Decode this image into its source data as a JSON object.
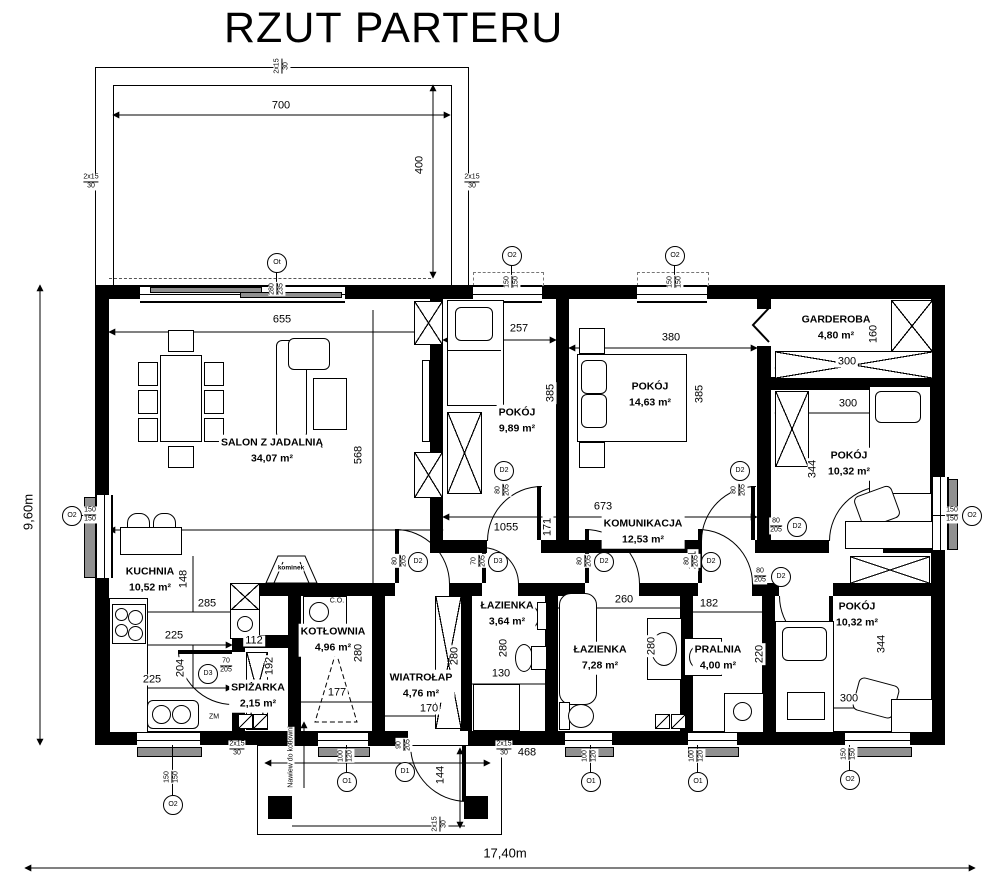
{
  "title": "RZUT PARTERU",
  "colors": {
    "wall": "#000000",
    "sill": "#909090",
    "paper": "#ffffff"
  },
  "rooms": {
    "salon": {
      "name": "SALON Z JADALNIĄ",
      "area": "34,07 m²"
    },
    "kuchnia": {
      "name": "KUCHNIA",
      "area": "10,52 m²"
    },
    "spizarka": {
      "name": "SPIŻARKA",
      "area": "2,15 m²"
    },
    "kotlownia": {
      "name": "KOTŁOWNIA",
      "area": "4,96 m²"
    },
    "wiatrolap": {
      "name": "WIATROŁAP",
      "area": "4,76 m²"
    },
    "lazienka_mala": {
      "name": "ŁAZIENKA",
      "area": "3,64 m²"
    },
    "lazienka_duza": {
      "name": "ŁAZIENKA",
      "area": "7,28 m²"
    },
    "pralnia": {
      "name": "PRALNIA",
      "area": "4,00 m²"
    },
    "komunikacja": {
      "name": "KOMUNIKACJA",
      "area": "12,53 m²"
    },
    "pokoj_a": {
      "name": "POKÓJ",
      "area": "9,89 m²"
    },
    "pokoj_b": {
      "name": "POKÓJ",
      "area": "14,63 m²"
    },
    "garderoba": {
      "name": "GARDEROBA",
      "area": "4,80 m²"
    },
    "pokoj_c": {
      "name": "POKÓJ",
      "area": "10,32 m²"
    },
    "pokoj_d": {
      "name": "POKÓJ",
      "area": "10,32 m²"
    }
  },
  "dims": {
    "terrace_w": "700",
    "terrace_h": "400",
    "salon_w": "655",
    "salon_h": "568",
    "pokoj_a_w": "257",
    "pokoj_a_h": "385",
    "pokoj_b_w": "380",
    "pokoj_b_h": "385",
    "garderoba_w": "300",
    "garderoba_h": "160",
    "pokoj_c_w": "300",
    "pokoj_c_h": "344",
    "pokoj_d_w": "300",
    "pokoj_d_h": "344",
    "kuchnia_d": "148",
    "kuchnia_w": "285",
    "kuchnia_a": "225",
    "kuchnia_b": "225",
    "kuchnia_h": "204",
    "spizarka_w": "112",
    "spizarka_h": "192",
    "kotlownia_w": "177",
    "kotlownia_h": "280",
    "wiatrolap_w": "170",
    "wiatrolap_h": "280",
    "lazienka_mala_w": "130",
    "lazienka_mala_h": "280",
    "lazienka_duza_w": "260",
    "lazienka_duza_h": "280",
    "pralnia_w": "182",
    "pralnia_h": "220",
    "kom_a": "1055",
    "kom_b": "171",
    "kom_c": "673",
    "kom_d": "231",
    "porch_w": "468",
    "porch_d": "144",
    "total_w": "17,40m",
    "total_h": "9,60m"
  },
  "openings": {
    "o1": {
      "tag": "O1",
      "size_a": "100",
      "size_b": "120"
    },
    "o2": {
      "tag": "O2",
      "size_a": "150",
      "size_b": "150"
    },
    "ot": {
      "tag": "Ot",
      "size_a": "280",
      "size_b": "235"
    },
    "d1": {
      "tag": "D1",
      "size_a": "90",
      "size_b": "205"
    },
    "d2": {
      "tag": "D2",
      "size_a": "80",
      "size_b": "205"
    },
    "d3": {
      "tag": "D3",
      "size_a": "70",
      "size_b": "205"
    }
  },
  "lintel": {
    "a": "2x15",
    "b": "30"
  },
  "annotations": {
    "kominek": "kominek",
    "boiler": "C.O.",
    "zm": "ZM",
    "nawiew": "Nawiew do kotłowni"
  }
}
